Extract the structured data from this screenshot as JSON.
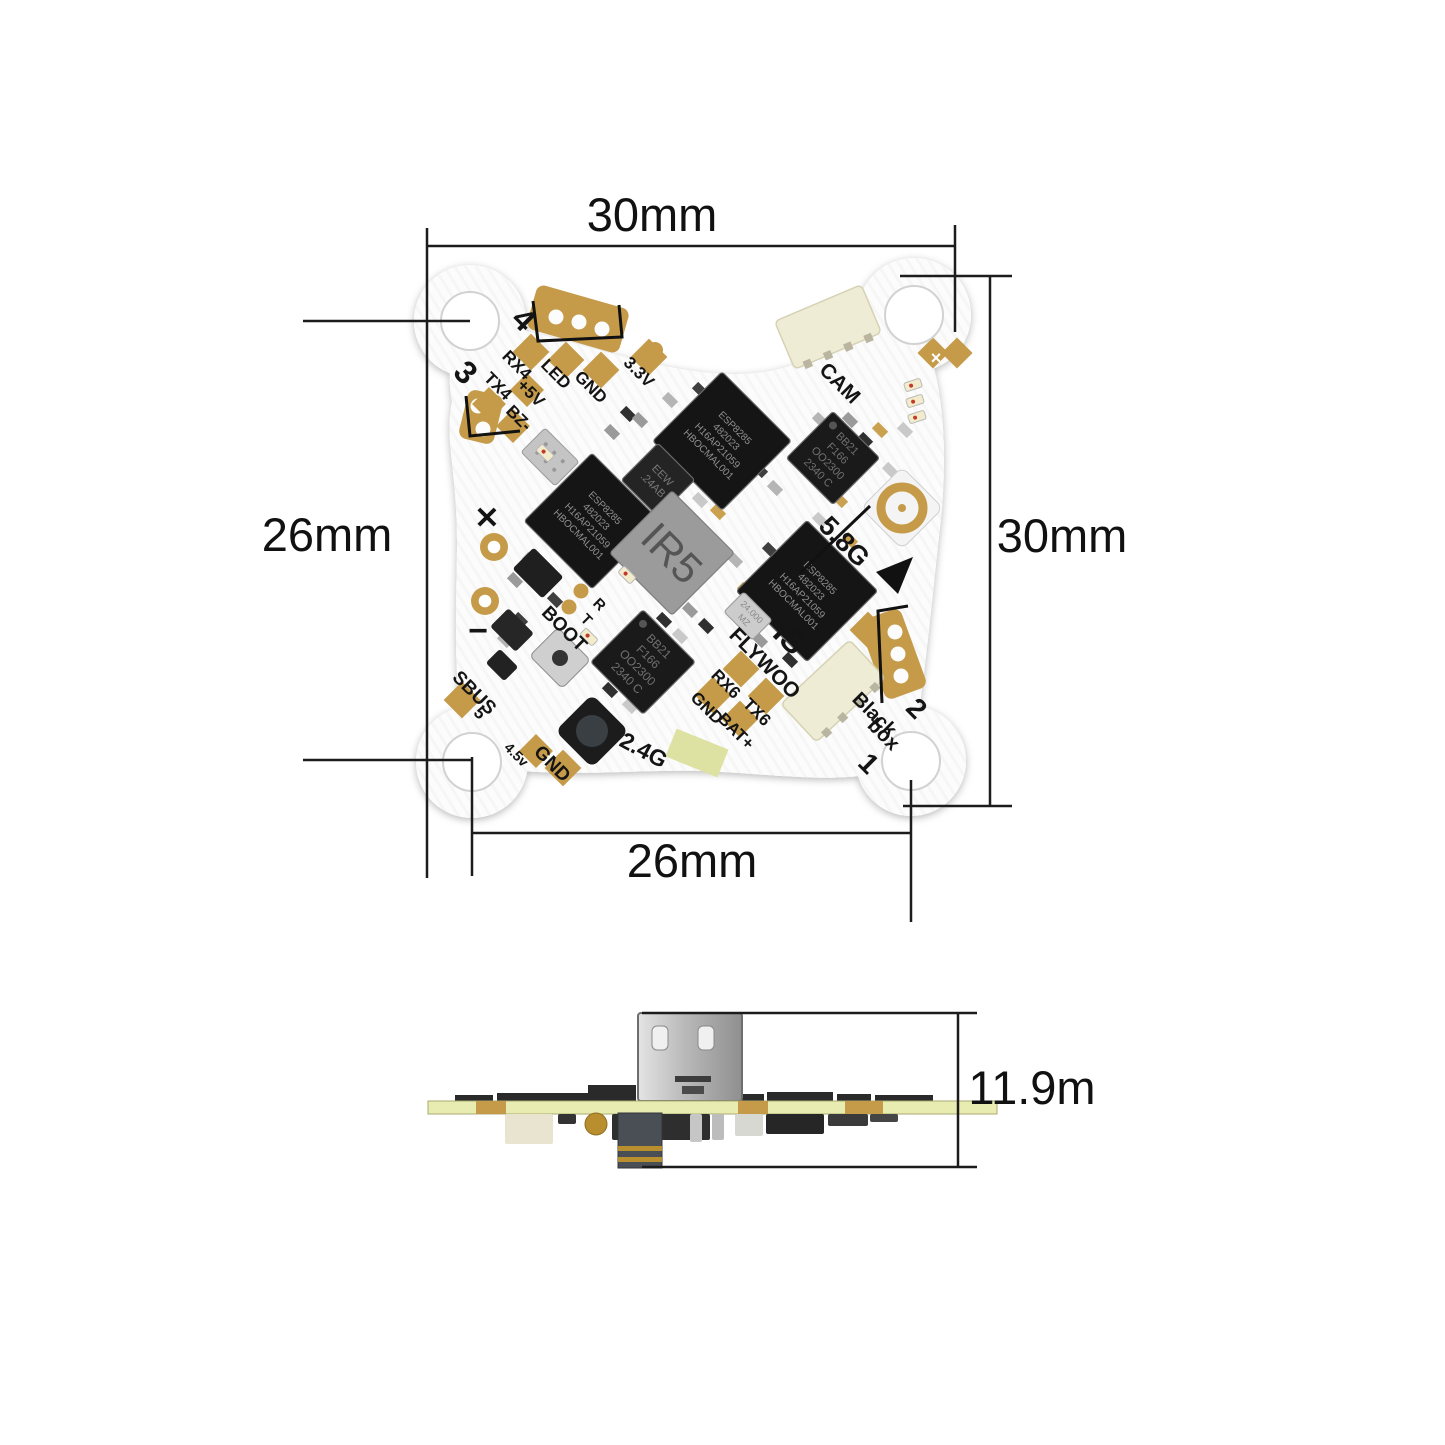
{
  "figure": {
    "type": "product-dimension-diagram",
    "subject": "AIO flight controller PCB, top view and side view"
  },
  "dimensions": {
    "top_width": {
      "label": "30mm"
    },
    "left_height": {
      "label": "26mm"
    },
    "right_height": {
      "label": "30mm"
    },
    "bottom_width": {
      "label": "26mm"
    },
    "side_height": {
      "label": "11.9m"
    }
  },
  "colors": {
    "gold": "#c59b4a",
    "board_white": "#fcfcfc",
    "chip_black": "#161616",
    "connector_beige": "#efecd6",
    "side_pcb_green": "#e9ecb0",
    "dim_line": "#1c1c1c",
    "antenna_pad_green": "#dde2a2"
  },
  "board": {
    "mount_holes": [
      {
        "x": 470,
        "y": 321,
        "r": 29
      },
      {
        "x": 914,
        "y": 315,
        "r": 29
      },
      {
        "x": 911,
        "y": 761,
        "r": 29
      },
      {
        "x": 472,
        "y": 762,
        "r": 29
      }
    ],
    "silkscreen_labels": [
      {
        "t": "4",
        "x": 516,
        "y": 327,
        "r": 45,
        "s": 32,
        "w": 700
      },
      {
        "t": "3",
        "x": 458,
        "y": 380,
        "r": 45,
        "s": 32,
        "w": 700
      },
      {
        "t": "RX4",
        "x": 513,
        "y": 369,
        "r": 45,
        "s": 17,
        "w": 600
      },
      {
        "t": "LED",
        "x": 552,
        "y": 378,
        "r": 45,
        "s": 17,
        "w": 600
      },
      {
        "t": "GND",
        "x": 587,
        "y": 391,
        "r": 45,
        "s": 17,
        "w": 600
      },
      {
        "t": "3.3V",
        "x": 635,
        "y": 376,
        "r": 45,
        "s": 17,
        "w": 600
      },
      {
        "t": "TX4",
        "x": 494,
        "y": 390,
        "r": 45,
        "s": 17,
        "w": 600
      },
      {
        "t": "+5V",
        "x": 527,
        "y": 397,
        "r": 45,
        "s": 17,
        "w": 600
      },
      {
        "t": "BZ-",
        "x": 515,
        "y": 422,
        "r": 45,
        "s": 17,
        "w": 600
      },
      {
        "t": "CAM",
        "x": 835,
        "y": 388,
        "r": 45,
        "s": 21,
        "w": 600
      },
      {
        "t": "5.8G",
        "x": 838,
        "y": 548,
        "r": 45,
        "s": 27,
        "w": 700
      },
      {
        "t": "✕",
        "x": 487,
        "y": 528,
        "r": 0,
        "s": 30,
        "w": 900
      },
      {
        "t": "−",
        "x": 478,
        "y": 642,
        "r": 0,
        "s": 34,
        "w": 900
      },
      {
        "t": "BOOT",
        "x": 560,
        "y": 633,
        "r": 45,
        "s": 19,
        "w": 600
      },
      {
        "t": "R",
        "x": 596,
        "y": 608,
        "r": 45,
        "s": 15,
        "w": 600
      },
      {
        "t": "T",
        "x": 583,
        "y": 623,
        "r": 45,
        "s": 15,
        "w": 600
      },
      {
        "t": "SBUS",
        "x": 470,
        "y": 697,
        "r": 45,
        "s": 19,
        "w": 600
      },
      {
        "t": "5",
        "x": 476,
        "y": 717,
        "r": 45,
        "s": 17,
        "w": 600
      },
      {
        "t": "4.5v",
        "x": 513,
        "y": 758,
        "r": 45,
        "s": 14,
        "w": 600
      },
      {
        "t": "GND",
        "x": 548,
        "y": 768,
        "r": 45,
        "s": 19,
        "w": 600
      },
      {
        "t": "2.4G",
        "x": 640,
        "y": 757,
        "r": 28,
        "s": 23,
        "w": 600
      },
      {
        "t": "RX6",
        "x": 722,
        "y": 688,
        "r": 45,
        "s": 17,
        "w": 600
      },
      {
        "t": "GND",
        "x": 703,
        "y": 712,
        "r": 45,
        "s": 17,
        "w": 600
      },
      {
        "t": "TX6",
        "x": 753,
        "y": 716,
        "r": 45,
        "s": 17,
        "w": 600
      },
      {
        "t": "BAT+",
        "x": 732,
        "y": 735,
        "r": 45,
        "s": 17,
        "w": 600
      },
      {
        "t": "FLYWOO",
        "x": 760,
        "y": 668,
        "r": 45,
        "s": 21,
        "w": 600
      },
      {
        "t": "IS",
        "x": 782,
        "y": 646,
        "r": 45,
        "s": 32,
        "w": 700
      },
      {
        "t": "Black",
        "x": 870,
        "y": 719,
        "r": 45,
        "s": 20,
        "w": 600
      },
      {
        "t": "box",
        "x": 879,
        "y": 739,
        "r": 45,
        "s": 20,
        "w": 600
      },
      {
        "t": "2",
        "x": 910,
        "y": 715,
        "r": 45,
        "s": 28,
        "w": 700
      },
      {
        "t": "1",
        "x": 862,
        "y": 770,
        "r": 45,
        "s": 28,
        "w": 700
      },
      {
        "t": "×",
        "x": 936,
        "y": 364,
        "r": 0,
        "s": 18,
        "w": 700,
        "c": "#ffffff"
      }
    ],
    "chips": [
      {
        "name": "esp-chip-top",
        "lines": [
          "ESP8285",
          "482023",
          "H16AP21059",
          "HBOCMAL001"
        ],
        "x": 722,
        "y": 441,
        "w": 98,
        "h": 98,
        "r": 45,
        "fill": "#151515",
        "tc": "#8f8f8f",
        "fs": 10
      },
      {
        "name": "esp-chip-left",
        "lines": [
          "ESP8285",
          "482023",
          "H16AP21059",
          "HBOCMAL001"
        ],
        "x": 592,
        "y": 521,
        "w": 96,
        "h": 96,
        "r": 45,
        "fill": "#151515",
        "tc": "#8f8f8f",
        "fs": 10
      },
      {
        "name": "esp-chip-right",
        "lines": [
          "ESP8285",
          "482023",
          "H16AP21059",
          "HBOCMAL001"
        ],
        "x": 807,
        "y": 591,
        "w": 100,
        "h": 100,
        "r": 45,
        "fill": "#151515",
        "tc": "#8f8f8f",
        "fs": 10
      },
      {
        "name": "bb21-chip-right",
        "lines": [
          "BB21",
          "F166",
          "OO2300",
          "2340 C"
        ],
        "x": 833,
        "y": 458,
        "w": 66,
        "h": 66,
        "r": 45,
        "fill": "#1a1a1a",
        "tc": "#707070",
        "fs": 11
      },
      {
        "name": "bb21-chip-bottom",
        "lines": [
          "BB21",
          "F166",
          "OO2300",
          "2340 C"
        ],
        "x": 643,
        "y": 662,
        "w": 74,
        "h": 74,
        "r": 45,
        "fill": "#1a1a1a",
        "tc": "#707070",
        "fs": 12
      },
      {
        "name": "eeprom-chip",
        "lines": [
          "EEW",
          ".24AB"
        ],
        "x": 658,
        "y": 480,
        "w": 52,
        "h": 52,
        "r": 45,
        "fill": "#242424",
        "tc": "#787878",
        "fs": 11
      },
      {
        "name": "power-inductor",
        "lines": [
          "IR5"
        ],
        "x": 672,
        "y": 553,
        "w": 88,
        "h": 88,
        "r": 45,
        "fill": "#9b9b9b",
        "tc": "#555555",
        "fs": 42,
        "stroke": "#7e7e7e"
      },
      {
        "name": "crystal-oscillator",
        "lines": [
          "24.000",
          "MZ"
        ],
        "x": 748,
        "y": 616,
        "w": 40,
        "h": 28,
        "r": 45,
        "fill": "#cccccc",
        "tc": "#8a8a8a",
        "fs": 9,
        "stroke": "#9f9f9f"
      }
    ],
    "connectors": [
      {
        "name": "cam-connector",
        "x": 828,
        "y": 327,
        "w": 94,
        "h": 52,
        "r": -23
      },
      {
        "name": "blackbox-connector",
        "x": 833,
        "y": 691,
        "w": 94,
        "h": 52,
        "r": -43
      }
    ],
    "ufl_antenna": {
      "x": 902,
      "y": 508,
      "base": 58,
      "ring": 21
    },
    "leds": [
      {
        "x": 913,
        "y": 385,
        "r": -18
      },
      {
        "x": 915,
        "y": 401,
        "r": -18
      },
      {
        "x": 917,
        "y": 417,
        "r": -18
      },
      {
        "x": 627,
        "y": 575,
        "r": 45
      },
      {
        "x": 589,
        "y": 637,
        "r": 45
      },
      {
        "x": 545,
        "y": 453,
        "r": 45
      }
    ],
    "gold_pads": [
      [
        531,
        352,
        26
      ],
      [
        566,
        360,
        26
      ],
      [
        601,
        370,
        26
      ],
      [
        649,
        357,
        26
      ],
      [
        527,
        390,
        24
      ],
      [
        489,
        404,
        24
      ],
      [
        513,
        426,
        24
      ],
      [
        462,
        700,
        26
      ],
      [
        536,
        751,
        24
      ],
      [
        563,
        768,
        26
      ],
      [
        741,
        669,
        26
      ],
      [
        713,
        695,
        26
      ],
      [
        766,
        696,
        26
      ],
      [
        740,
        719,
        26
      ],
      [
        868,
        630,
        26
      ],
      [
        933,
        353,
        22
      ],
      [
        957,
        353,
        22
      ]
    ],
    "gold_rings": [
      [
        494,
        547,
        14
      ],
      [
        485,
        601,
        14
      ]
    ],
    "gold_dots": [
      [
        581,
        591,
        7.5
      ],
      [
        569,
        607,
        7.5
      ],
      [
        655,
        350,
        8
      ]
    ],
    "footprints": [
      {
        "x": 578,
        "y": 319,
        "w": 96,
        "h": 46,
        "r": 16,
        "holes": [
          [
            556,
            317
          ],
          [
            579,
            322
          ],
          [
            602,
            329
          ]
        ]
      },
      {
        "x": 481,
        "y": 417,
        "w": 36,
        "h": 50,
        "r": 14,
        "holes": [
          [
            478,
            406
          ],
          [
            483,
            429
          ]
        ]
      },
      {
        "x": 893,
        "y": 654,
        "w": 84,
        "h": 44,
        "r": 70,
        "holes": [
          [
            895,
            632
          ],
          [
            898,
            654
          ],
          [
            901,
            676
          ]
        ]
      }
    ],
    "brackets": [
      "M533,301 L538,341 L622,337 L619,305",
      "M466,396 L470,436 L520,431",
      "M908,606 L878,611 L882,703"
    ],
    "antenna_pad": {
      "x": 697,
      "y": 753,
      "w": 56,
      "h": 30,
      "r": 22
    },
    "button": {
      "x": 592,
      "y": 731,
      "s": 52
    },
    "shield_can": {
      "x": 550,
      "y": 457,
      "w": 48,
      "h": 34
    },
    "metal_part": {
      "x": 560,
      "y": 658,
      "w": 46,
      "h": 40
    },
    "underline_5g8": "M800,573 L870,506",
    "orientation_arrow": "M913 557 L876 572 L898 594 Z"
  },
  "side_view": {
    "board": {
      "x": 428,
      "y": 1101,
      "w": 569,
      "h": 13
    },
    "gold_segments": [
      [
        476,
        30
      ],
      [
        738,
        30
      ],
      [
        845,
        38
      ]
    ],
    "usb": {
      "x": 638,
      "y": 1013,
      "w": 104,
      "h": 88
    },
    "pillar": {
      "x": 618,
      "y": 1113,
      "w": 44,
      "h": 55
    },
    "top_parts": [
      [
        497,
        1093,
        96,
        8
      ],
      [
        588,
        1085,
        48,
        16
      ],
      [
        742,
        1094,
        22,
        7
      ],
      [
        767,
        1092,
        66,
        9
      ],
      [
        837,
        1094,
        34,
        7
      ],
      [
        875,
        1095,
        58,
        6
      ],
      [
        455,
        1095,
        38,
        6
      ]
    ],
    "bottom_parts": [
      [
        505,
        1114,
        48,
        30,
        "#e8e4cf"
      ],
      [
        558,
        1114,
        18,
        10,
        "#333333"
      ],
      [
        612,
        1114,
        98,
        26,
        "#2e2e2e"
      ],
      [
        648,
        1114,
        14,
        26,
        "#c2c2c2"
      ],
      [
        690,
        1114,
        12,
        28,
        "#c6c6c6"
      ],
      [
        712,
        1114,
        12,
        26,
        "#bcbcbc"
      ],
      [
        735,
        1114,
        28,
        22,
        "#d8d8d2"
      ],
      [
        766,
        1114,
        58,
        20,
        "#262626"
      ],
      [
        828,
        1114,
        40,
        12,
        "#3a3a3a"
      ],
      [
        870,
        1114,
        28,
        8,
        "#454545"
      ]
    ],
    "gold_circle": {
      "cx": 596,
      "cy": 1124,
      "r": 11
    }
  }
}
